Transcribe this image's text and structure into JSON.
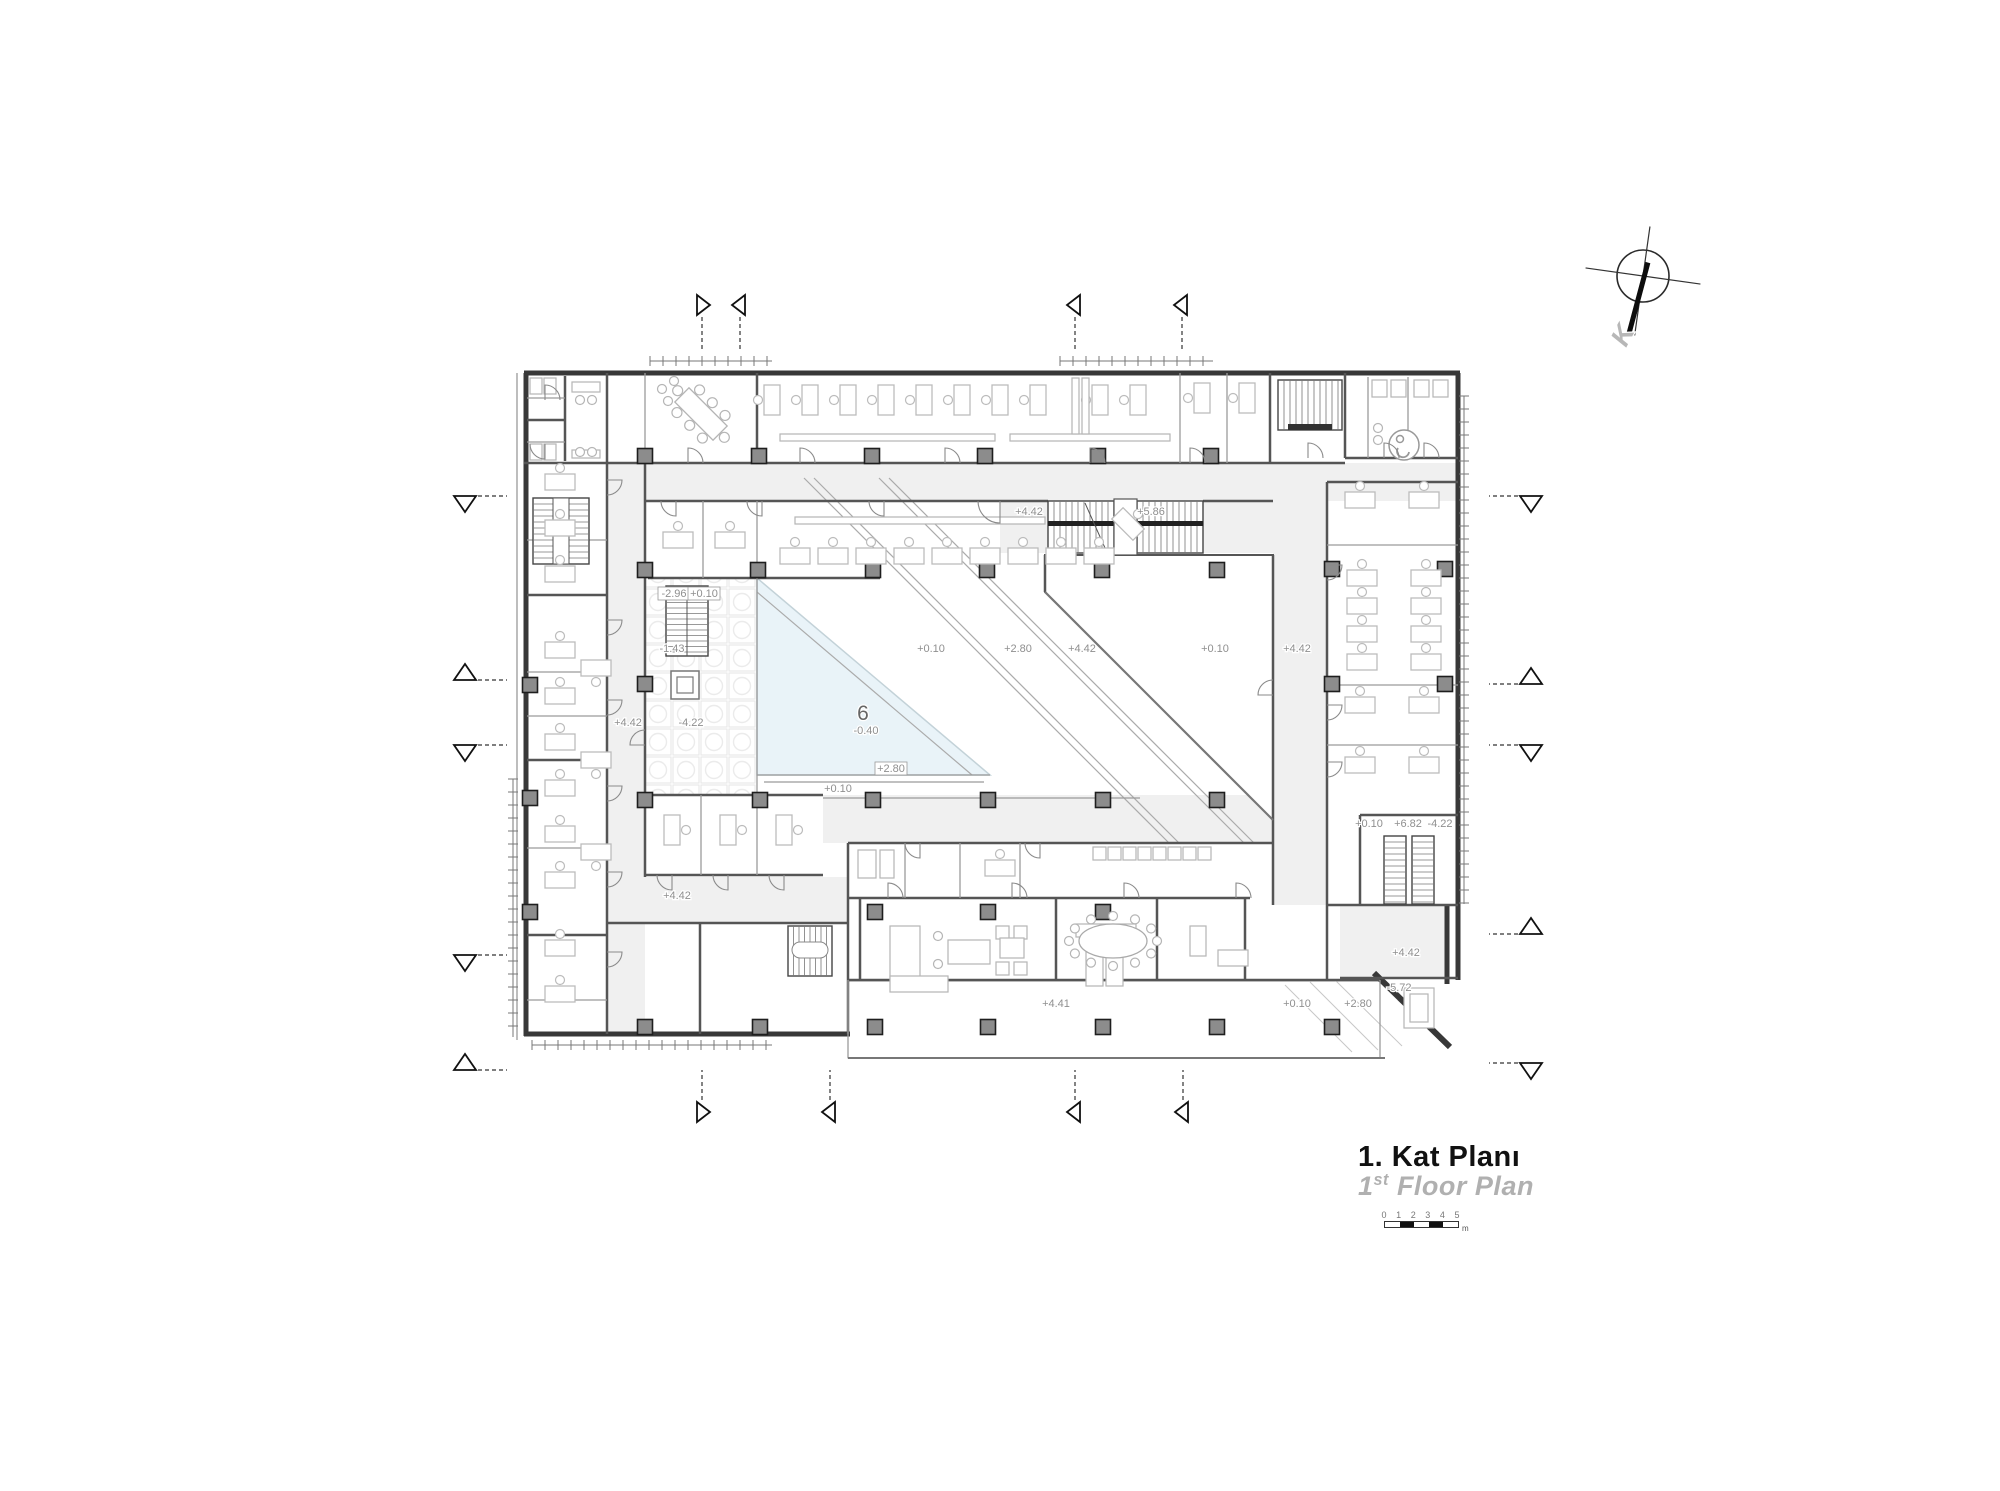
{
  "title_block": {
    "title_primary": "1. Kat Planı",
    "title_secondary_prefix": "1",
    "title_secondary_sup": "st",
    "title_secondary_rest": " Floor Plan",
    "scale_bar": {
      "ticks": [
        "0",
        "1",
        "2",
        "3",
        "4",
        "5"
      ],
      "unit": "m"
    }
  },
  "north_arrow": {
    "label": "K"
  },
  "plan": {
    "atrium_room_number": {
      "number": "6",
      "level": "-0.40"
    },
    "elevation_labels": [
      {
        "text": "-2.96",
        "x": 674,
        "y": 597,
        "boxed": true
      },
      {
        "text": "+0.10",
        "x": 704,
        "y": 597,
        "boxed": true
      },
      {
        "text": "-1.43",
        "x": 672,
        "y": 652
      },
      {
        "text": "-4.22",
        "x": 691,
        "y": 726
      },
      {
        "text": "+2.80",
        "x": 891,
        "y": 772,
        "boxed": true
      },
      {
        "text": "+0.10",
        "x": 838,
        "y": 792
      },
      {
        "text": "+0.10",
        "x": 931,
        "y": 652
      },
      {
        "text": "+2.80",
        "x": 1018,
        "y": 652
      },
      {
        "text": "+4.42",
        "x": 1082,
        "y": 652
      },
      {
        "text": "+4.42",
        "x": 1029,
        "y": 515
      },
      {
        "text": "+5.86",
        "x": 1151,
        "y": 515
      },
      {
        "text": "+0.10",
        "x": 1215,
        "y": 652
      },
      {
        "text": "+4.42",
        "x": 1297,
        "y": 652
      },
      {
        "text": "+4.42",
        "x": 628,
        "y": 726
      },
      {
        "text": "+4.42",
        "x": 677,
        "y": 899
      },
      {
        "text": "+0.10",
        "x": 1369,
        "y": 827
      },
      {
        "text": "+6.82",
        "x": 1408,
        "y": 827
      },
      {
        "text": "-4.22",
        "x": 1440,
        "y": 827
      },
      {
        "text": "+4.42",
        "x": 1406,
        "y": 956
      },
      {
        "text": "-5.72",
        "x": 1399,
        "y": 991
      },
      {
        "text": "+0.10",
        "x": 1297,
        "y": 1007
      },
      {
        "text": "+2.80",
        "x": 1358,
        "y": 1007
      },
      {
        "text": "+4.41",
        "x": 1056,
        "y": 1007
      }
    ]
  },
  "colors": {
    "wall": "#383838",
    "corridor": "#f0f0f0",
    "atrium_fill": "#e9f3f8",
    "label": "#8f8f8f",
    "title_secondary": "#b0b0b0"
  }
}
